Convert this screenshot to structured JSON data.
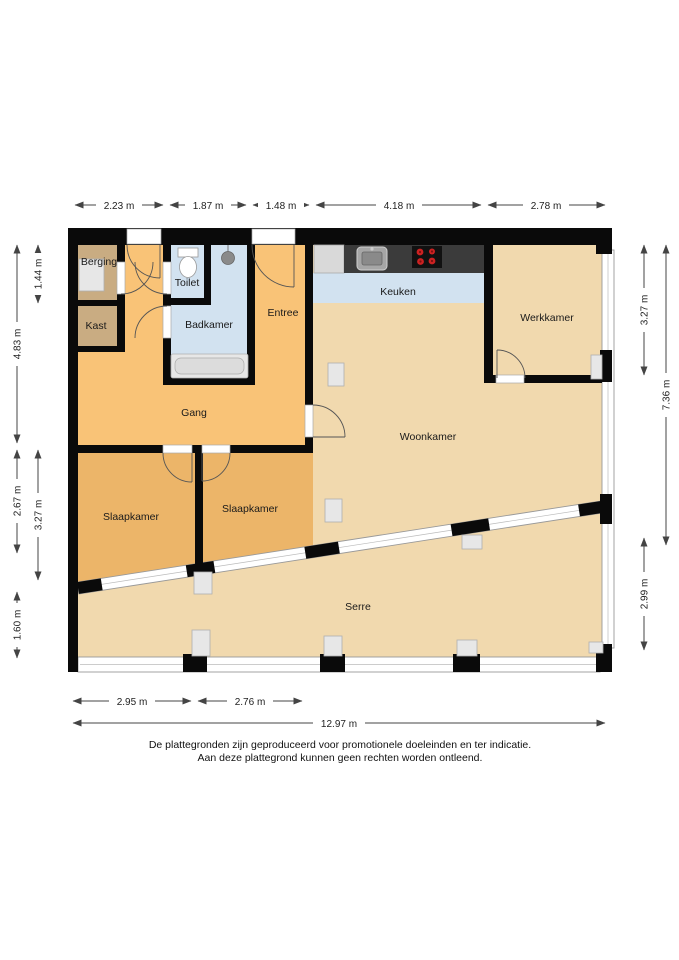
{
  "rooms": {
    "berging": "Berging",
    "kast": "Kast",
    "toilet": "Toilet",
    "badkamer": "Badkamer",
    "entree": "Entree",
    "keuken": "Keuken",
    "werkkamer": "Werkkamer",
    "gang": "Gang",
    "woonkamer": "Woonkamer",
    "slaapkamer_1": "Slaapkamer",
    "slaapkamer_2": "Slaapkamer",
    "serre": "Serre"
  },
  "dims": {
    "top": [
      "2.23 m",
      "1.87 m",
      "1.48 m",
      "4.18 m",
      "2.78 m"
    ],
    "left_outer": [
      "4.83 m",
      "2.67 m",
      "1.60 m"
    ],
    "left_inner": [
      "1.44 m",
      "3.27 m"
    ],
    "right_inner": [
      "3.27 m",
      "2.99 m"
    ],
    "right_outer": [
      "7.36 m"
    ],
    "bottom": [
      "2.95 m",
      "2.76 m"
    ],
    "total": "12.97 m"
  },
  "footer": {
    "line1": "De plattegronden zijn geproduceerd voor promotionele doeleinden en ter indicatie.",
    "line2": "Aan deze plattegrond kunnen geen rechten worden ontleend."
  },
  "colors": {
    "wall": "#0a0a0a",
    "hallway": "#f9c377",
    "bedroom": "#ecb569",
    "storage": "#c9ac82",
    "wet_room": "#d2e2f0",
    "living": "#f1d9ae",
    "counter": "#3b3b3b",
    "burner": "#cc2222",
    "fixture": "#e7e7e7",
    "frame": "#999999"
  }
}
